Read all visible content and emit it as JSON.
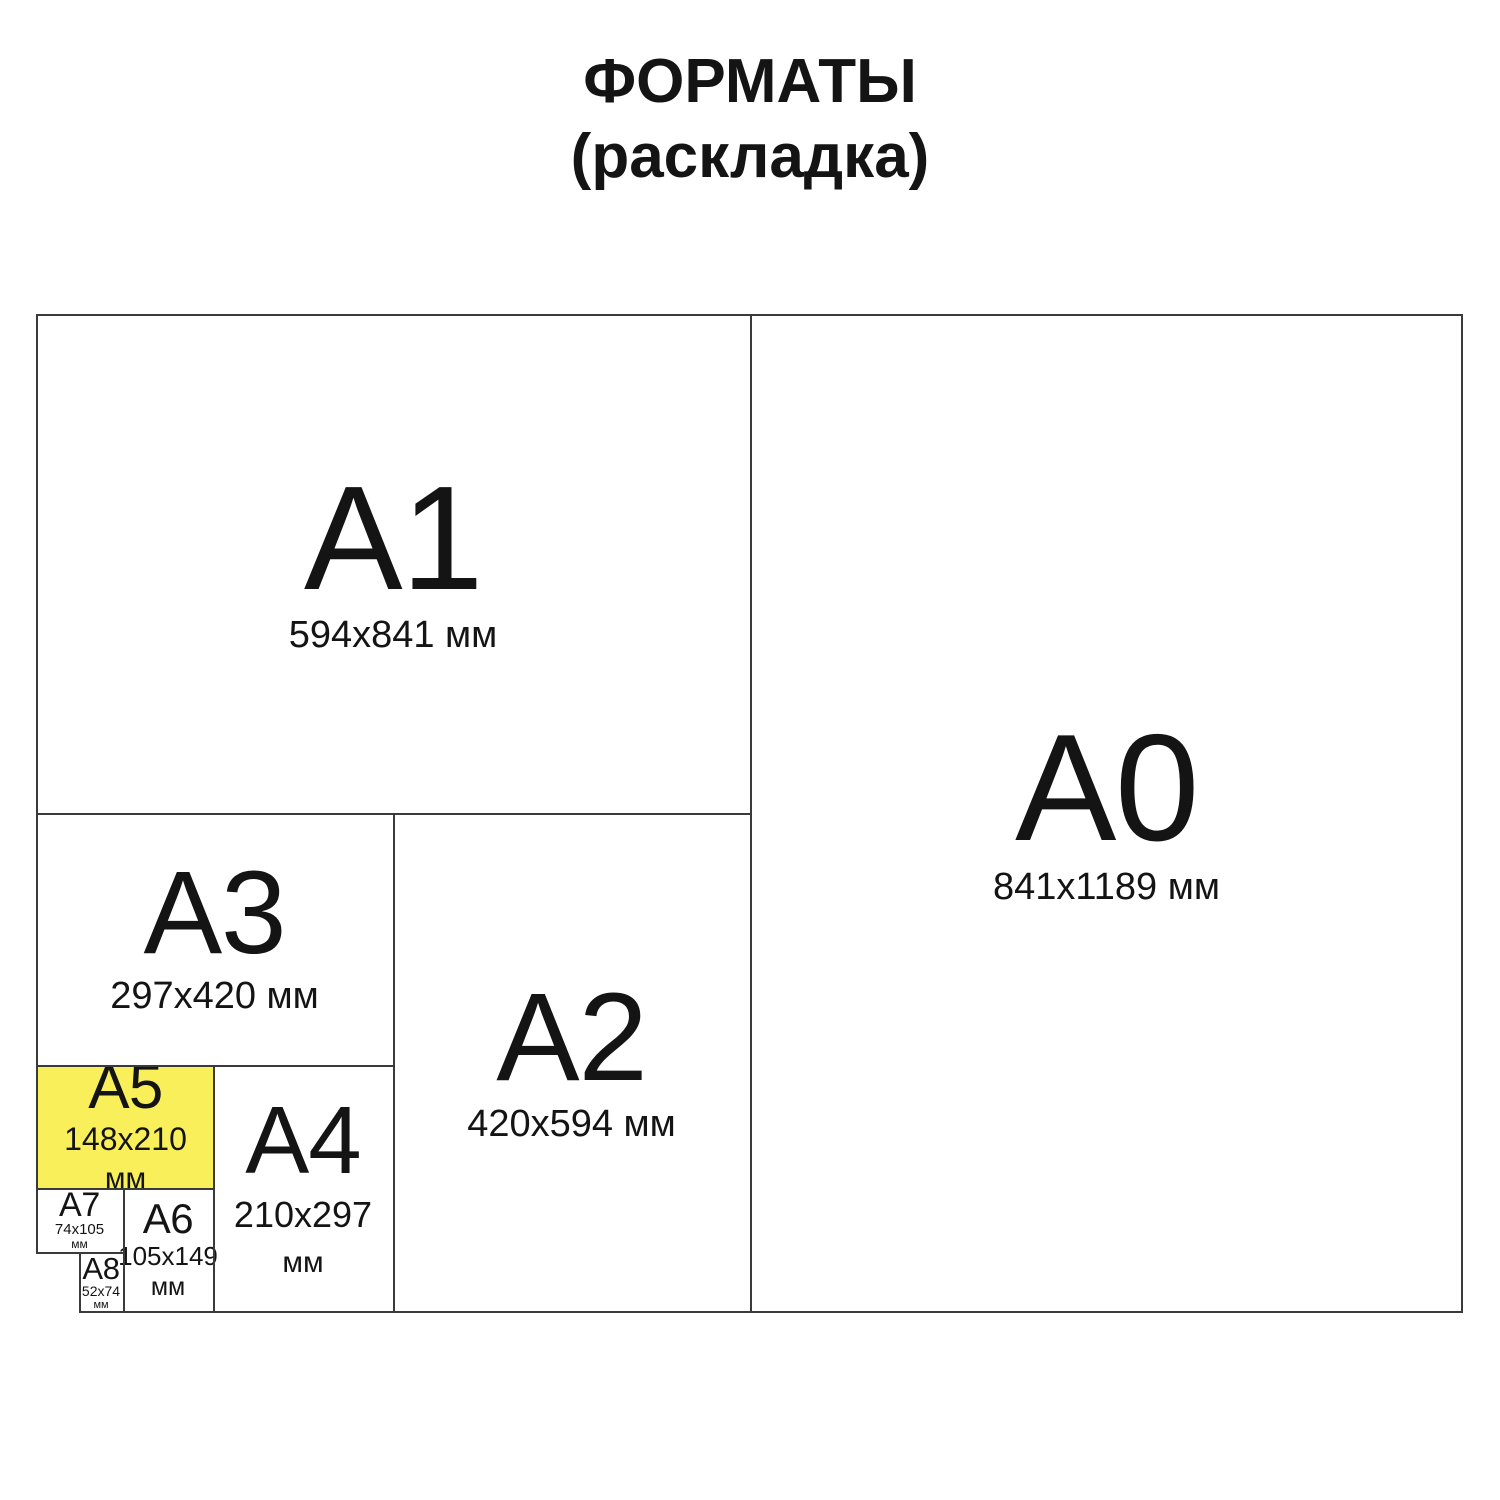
{
  "title": {
    "line1": "ФОРМАТЫ",
    "line2": "(раскладка)"
  },
  "colors": {
    "highlight": "#F8EF5B",
    "line": "#3A3A3A",
    "text": "#141414",
    "background": "#FFFFFF"
  },
  "formats": {
    "a0": {
      "label": "A0",
      "dims": "841x1189 мм",
      "highlighted": false
    },
    "a1": {
      "label": "A1",
      "dims": "594x841 мм",
      "highlighted": false
    },
    "a2": {
      "label": "A2",
      "dims": "420x594 мм",
      "highlighted": false
    },
    "a3": {
      "label": "A3",
      "dims": "297x420 мм",
      "highlighted": false
    },
    "a4": {
      "label": "A4",
      "dims": "210x297",
      "unit": "мм",
      "highlighted": false
    },
    "a5": {
      "label": "A5",
      "dims": "148x210",
      "unit": "мм",
      "highlighted": true
    },
    "a6": {
      "label": "A6",
      "dims": "105x149",
      "unit": "мм",
      "highlighted": false
    },
    "a7": {
      "label": "A7",
      "dims": "74x105",
      "unit": "мм",
      "highlighted": false
    },
    "a8": {
      "label": "A8",
      "dims": "52x74",
      "unit": "мм",
      "highlighted": false
    }
  }
}
